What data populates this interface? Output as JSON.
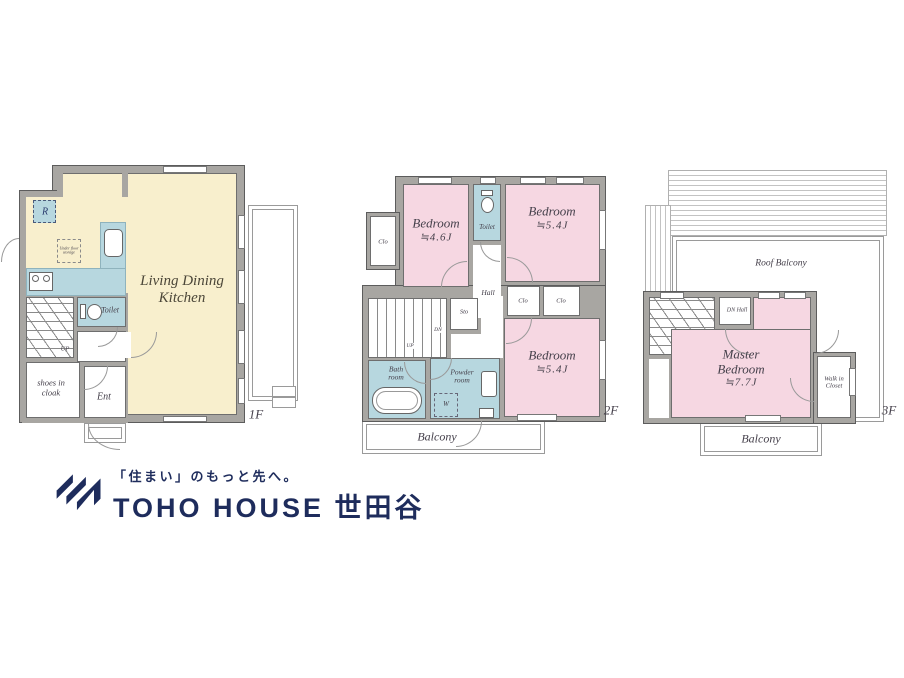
{
  "colors": {
    "room_pink": "#f6d7e2",
    "room_cream": "#f8efcd",
    "room_blue": "#b7d7df",
    "wall_gray": "#a8a6a2",
    "line_dark": "#5c5c5c",
    "label_dark": "#45404b",
    "brand_navy": "#1e2c5c"
  },
  "floor1": {
    "floor_label": "1F",
    "ldk_line1": "Living Dining",
    "ldk_line2": "Kitchen",
    "toilet_label": "Toilet",
    "shoes_line1": "shoes in",
    "shoes_line2": "cloak",
    "ent_label": "Ent",
    "up_label": "UP",
    "fridge_label": "R",
    "underfloor_line1": "Under floor",
    "underfloor_line2": "storage"
  },
  "floor2": {
    "floor_label": "2F",
    "bedroom1_name": "Bedroom",
    "bedroom1_size": "≒4.6J",
    "bedroom2_name": "Bedroom",
    "bedroom2_size": "≒5.4J",
    "bedroom3_name": "Bedroom",
    "bedroom3_size": "≒5.4J",
    "toilet_label": "Toilet",
    "closet_left": "Clo",
    "closet_mid": "Clo",
    "closet_right": "Clo",
    "hall_label": "Hall",
    "storage_label": "Sto",
    "down_label": "DN",
    "up_label": "UP",
    "bath_line1": "Bath",
    "bath_line2": "room",
    "powder_line1": "Powder",
    "powder_line2": "room",
    "washer_label": "W",
    "balcony_label": "Balcony"
  },
  "floor3": {
    "floor_label": "3F",
    "roof_balcony_label": "Roof Balcony",
    "dn_hall_label": "DN Hall",
    "master_line1": "Master",
    "master_line2": "Bedroom",
    "master_size": "≒7.7J",
    "wic_line1": "Walk in",
    "wic_line2": "Closet",
    "balcony_label": "Balcony"
  },
  "logo": {
    "tagline": "「住まい」のもっと先へ。",
    "brand": "TOHO HOUSE 世田谷"
  }
}
